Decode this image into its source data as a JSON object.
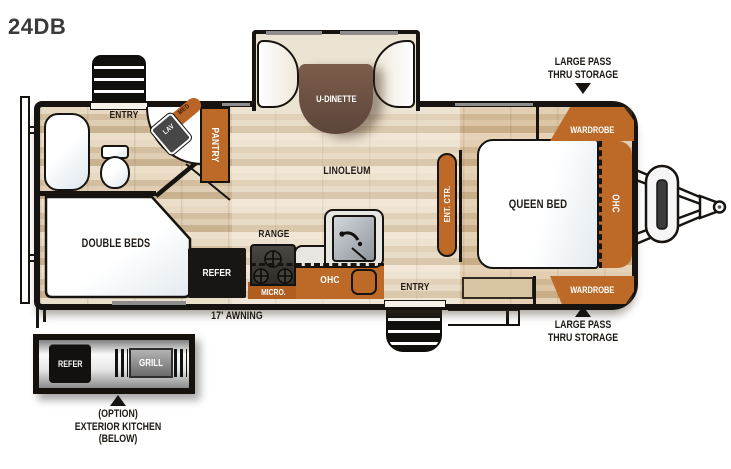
{
  "title": "24DB",
  "plan": {
    "dinette": "U-DINETTE",
    "entry_top": "ENTRY",
    "entry_bottom": "ENTRY",
    "tub": "TUB",
    "med": "MED",
    "lav": "LAV",
    "pantry": "PANTRY",
    "linoleum": "LINOLEUM",
    "double_beds": "DOUBLE BEDS",
    "refer": "REFER",
    "range": "RANGE",
    "micro": "MICRO.",
    "ohc_kitchen": "OHC",
    "ent_ctr": "ENT. CTR.",
    "queen_bed": "QUEEN BED",
    "ohc_bedroom": "OHC",
    "wardrobe_top": "WARDROBE",
    "wardrobe_bottom": "WARDROBE"
  },
  "annotations": {
    "storage_top_line1": "LARGE PASS",
    "storage_top_line2": "THRU STORAGE",
    "storage_bottom_line1": "LARGE PASS",
    "storage_bottom_line2": "THRU STORAGE",
    "awning": "17' AWNING"
  },
  "exterior_kitchen": {
    "refer": "REFER",
    "grill": "GRILL",
    "caption_line1": "(OPTION)",
    "caption_line2": "EXTERIOR KITCHEN",
    "caption_line3": "(BELOW)"
  },
  "colors": {
    "cabinet_orange": "#bd6a29",
    "wall_black": "#171310",
    "floor_tan": "#d9c5a6",
    "table_brown": "#6b5042",
    "fixture_white": "#ffffff",
    "appliance_black": "#181512"
  }
}
